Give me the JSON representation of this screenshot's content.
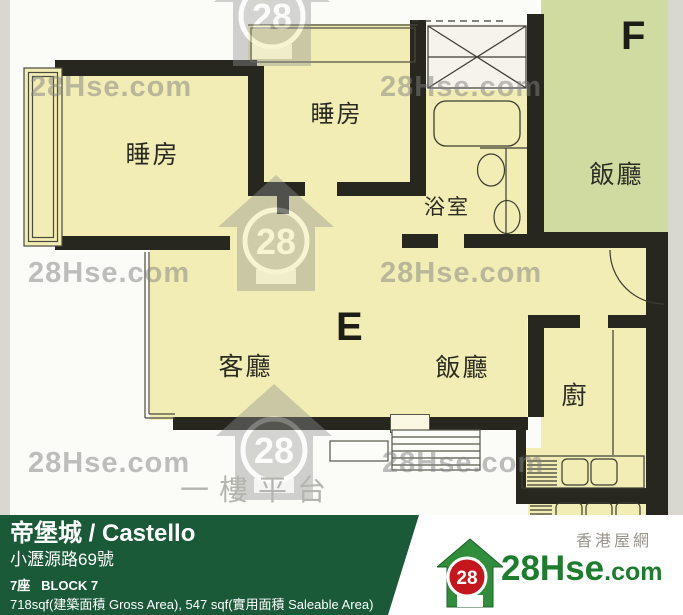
{
  "floorplan": {
    "unit_e_label": "E",
    "unit_f_label": "F",
    "bedroom_label": "睡房",
    "bathroom_label": "浴室",
    "living_label": "客廳",
    "dining_label": "飯廳",
    "kitchen_label": "廚",
    "platform_label": "一樓平台"
  },
  "watermark": {
    "text": "28Hse.com",
    "badge": "28"
  },
  "footer": {
    "estate_name": "帝堡城 / Castello",
    "address": "小瀝源路69號",
    "block": "7座   BLOCK 7",
    "area": "718sqf(建築面積 Gross Area), 547 sqf(實用面積 Saleable Area)"
  },
  "brand": {
    "site_cn": "香港屋網",
    "badge": "28",
    "name": "28Hse",
    "tld": ".com"
  },
  "colors": {
    "room_fill": "#f2edb4",
    "unit_f_fill": "#d0dba2",
    "wall": "#27271f",
    "footer_green": "#1b5a38",
    "brand_green": "#1e7c2f",
    "brand_red": "#c5161d",
    "watermark_gray": "#808080"
  }
}
